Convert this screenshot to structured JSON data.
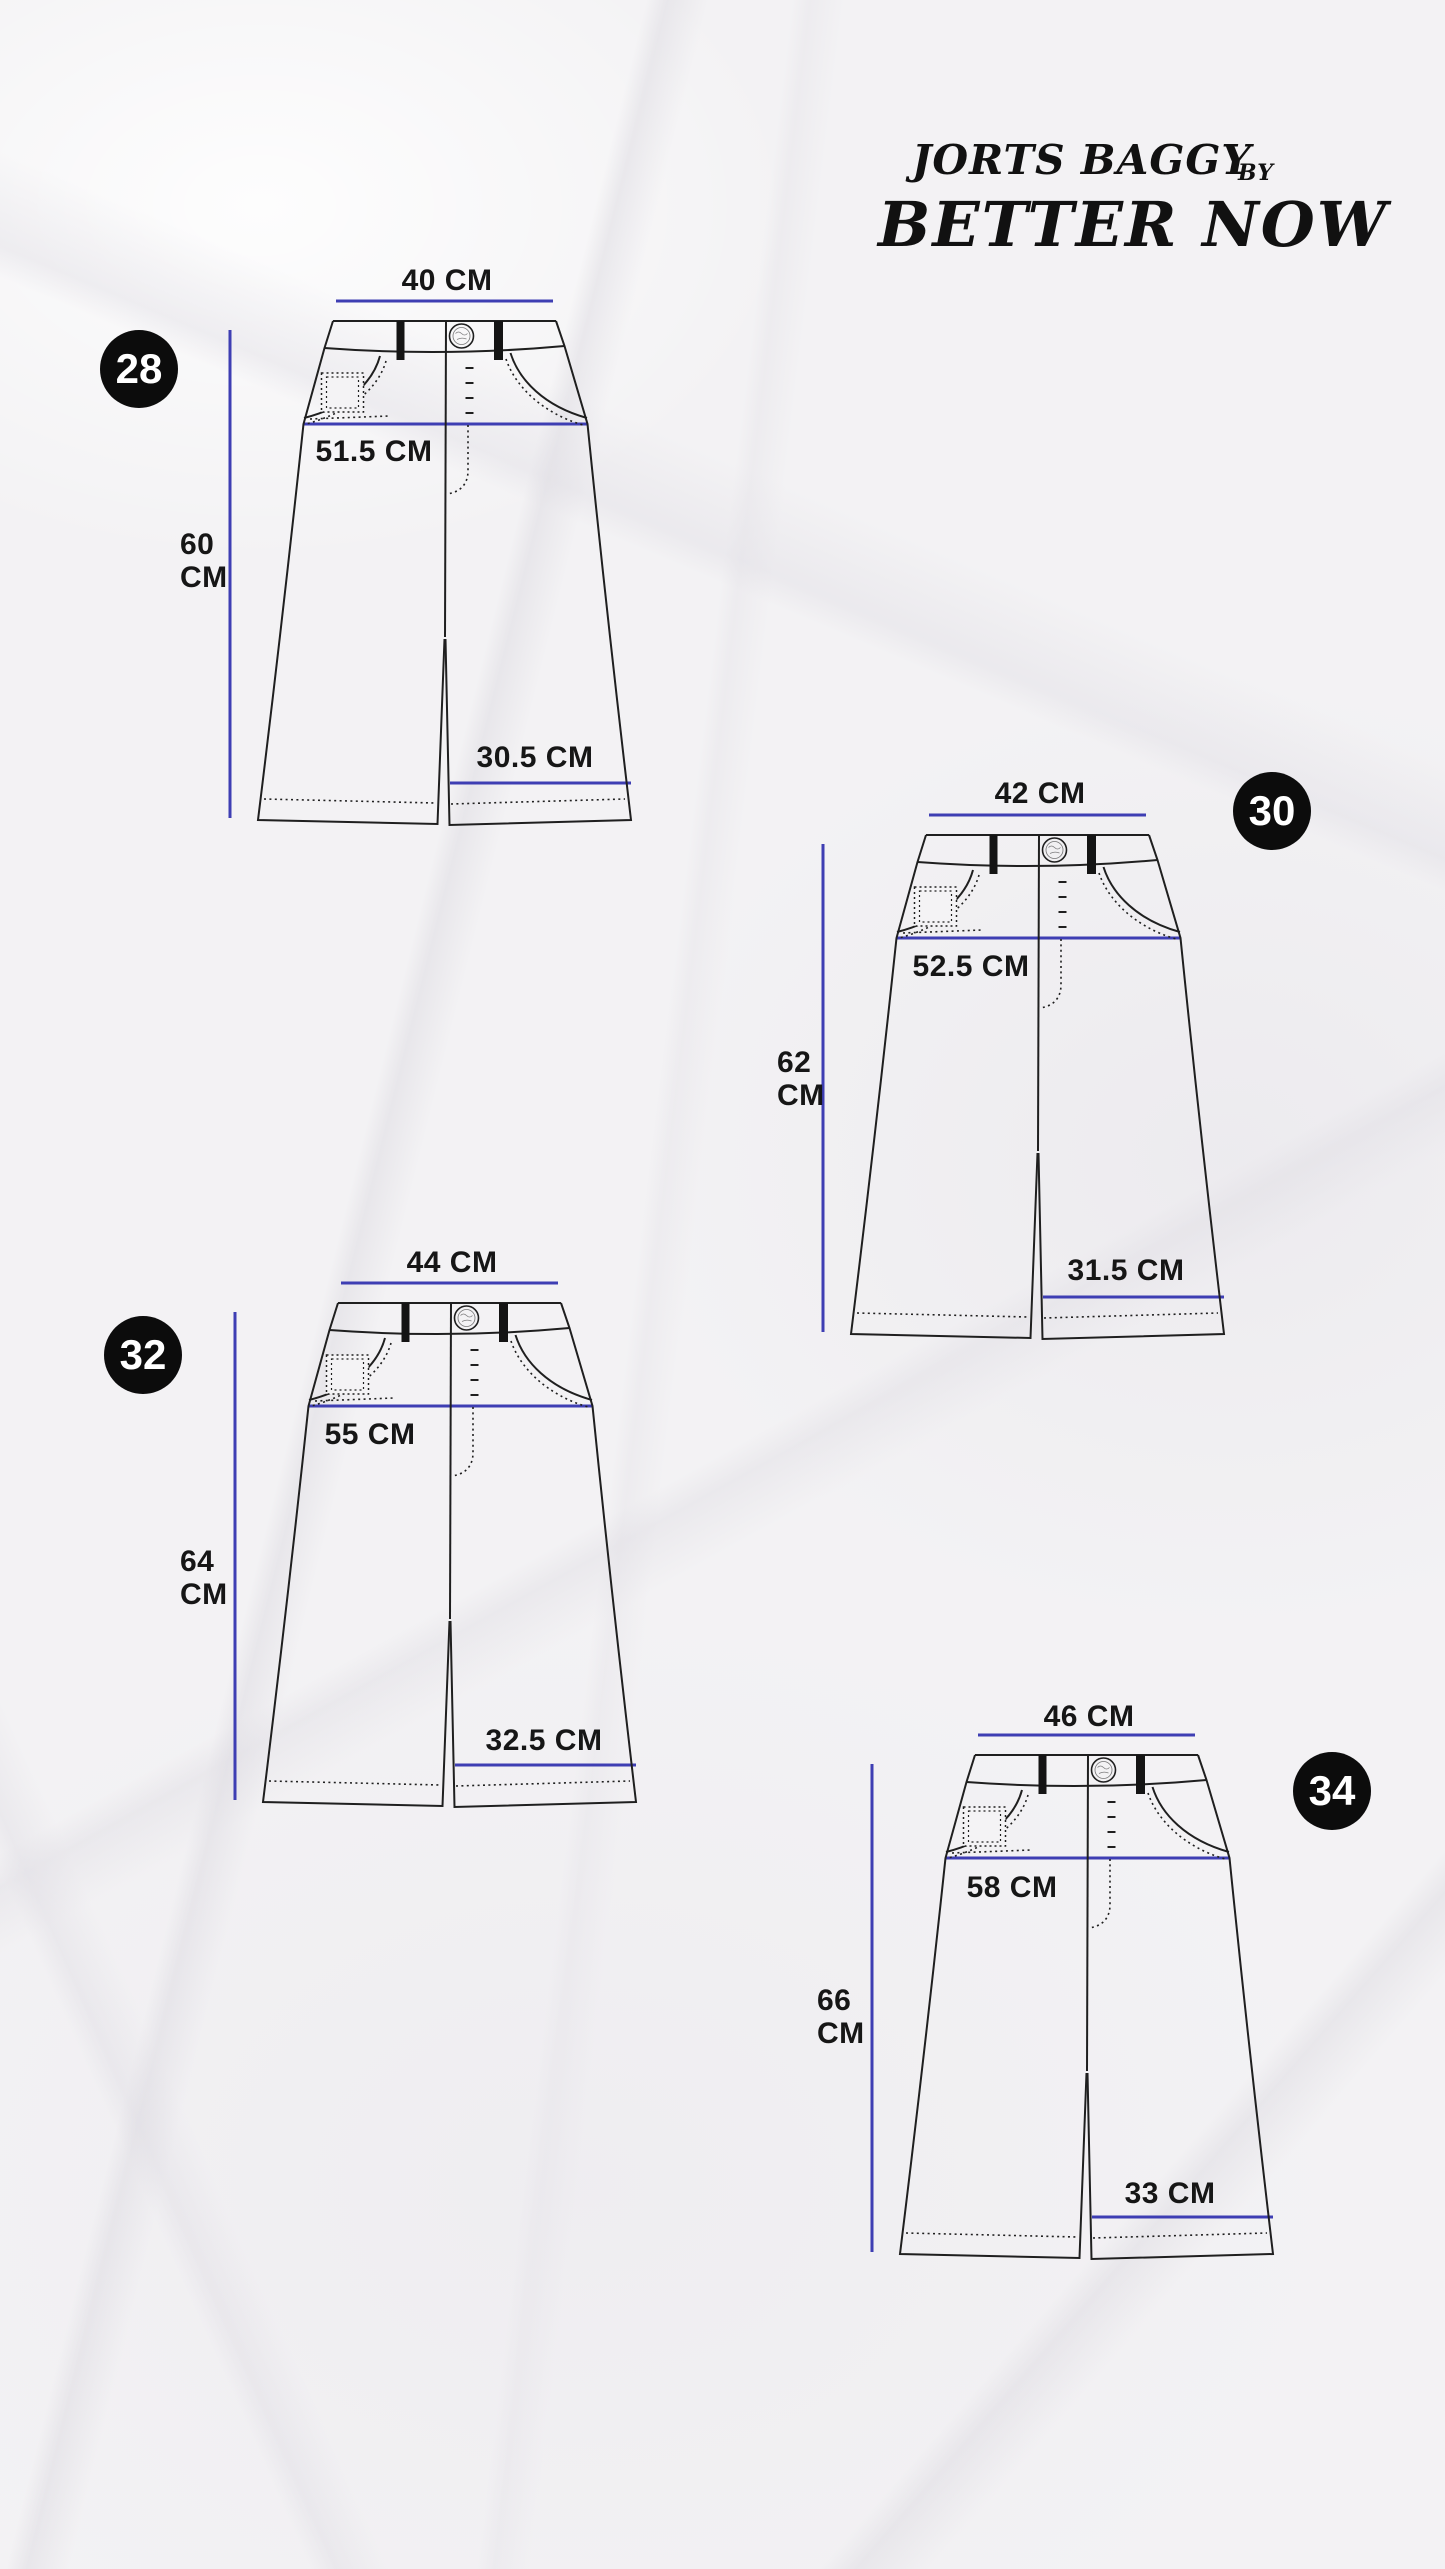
{
  "brand": {
    "product_line": "JORTS BAGGY",
    "by_label": "BY",
    "brand_name": "BETTER NOW"
  },
  "colors": {
    "accent": "#3e3eb3",
    "ink": "#1f1f1f",
    "paper": "#f3f2f4",
    "badge_bg": "#0c0c0c",
    "badge_text": "#ffffff"
  },
  "sizes": [
    {
      "badge": "28",
      "measurements": {
        "waist": "40 CM",
        "hip": "51.5 CM",
        "length": [
          "60",
          "CM"
        ],
        "leg_opening": "30.5 CM"
      }
    },
    {
      "badge": "30",
      "measurements": {
        "waist": "42 CM",
        "hip": "52.5 CM",
        "length": [
          "62",
          "CM"
        ],
        "leg_opening": "31.5 CM"
      }
    },
    {
      "badge": "32",
      "measurements": {
        "waist": "44 CM",
        "hip": "55 CM",
        "length": [
          "64",
          "CM"
        ],
        "leg_opening": "32.5 CM"
      }
    },
    {
      "badge": "34",
      "measurements": {
        "waist": "46 CM",
        "hip": "58 CM",
        "length": [
          "66",
          "CM"
        ],
        "leg_opening": "33 CM"
      }
    }
  ]
}
